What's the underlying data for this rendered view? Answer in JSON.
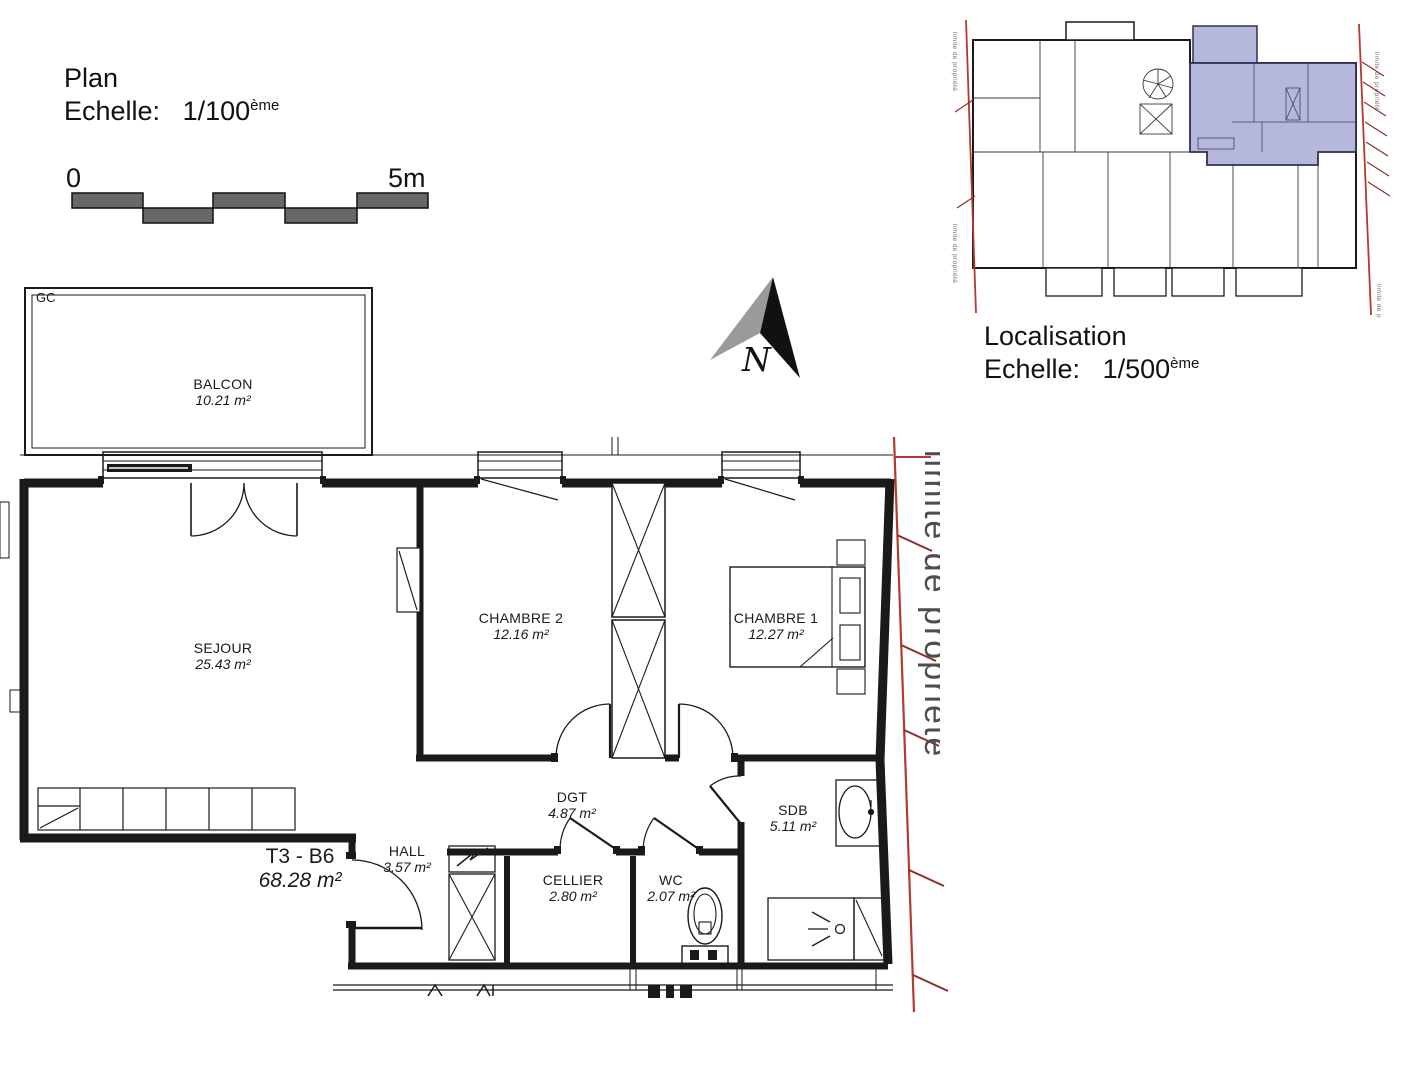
{
  "plan_header": {
    "title": "Plan",
    "scale_prefix": "Echelle:",
    "scale": "1/100",
    "scale_sup": "ème"
  },
  "loc_header": {
    "title": "Localisation",
    "scale_prefix": "Echelle:",
    "scale": "1/500",
    "scale_sup": "ème"
  },
  "scale_bar": {
    "start": "0",
    "end": "5m"
  },
  "north_label": "N",
  "balcony_tag": "GC",
  "apartment": {
    "code": "T3 - B6",
    "area": "68.28 m²"
  },
  "rooms": [
    {
      "name": "BALCON",
      "area": "10.21 m²"
    },
    {
      "name": "SEJOUR",
      "area": "25.43 m²"
    },
    {
      "name": "CHAMBRE 2",
      "area": "12.16 m²"
    },
    {
      "name": "CHAMBRE 1",
      "area": "12.27 m²"
    },
    {
      "name": "DGT",
      "area": "4.87 m²"
    },
    {
      "name": "SDB",
      "area": "5.11 m²"
    },
    {
      "name": "HALL",
      "area": "3.57 m²"
    },
    {
      "name": "CELLIER",
      "area": "2.80 m²"
    },
    {
      "name": "WC",
      "area": "2.07 m²"
    }
  ],
  "property_limit": "limite de propriété",
  "colors": {
    "line": "#1a1a1a",
    "red_line": "#b23b2e",
    "hatch": "#8c3026",
    "scale_fill": "#686868",
    "north_gray": "#9a9a9a",
    "highlight": "#b5b8da"
  }
}
